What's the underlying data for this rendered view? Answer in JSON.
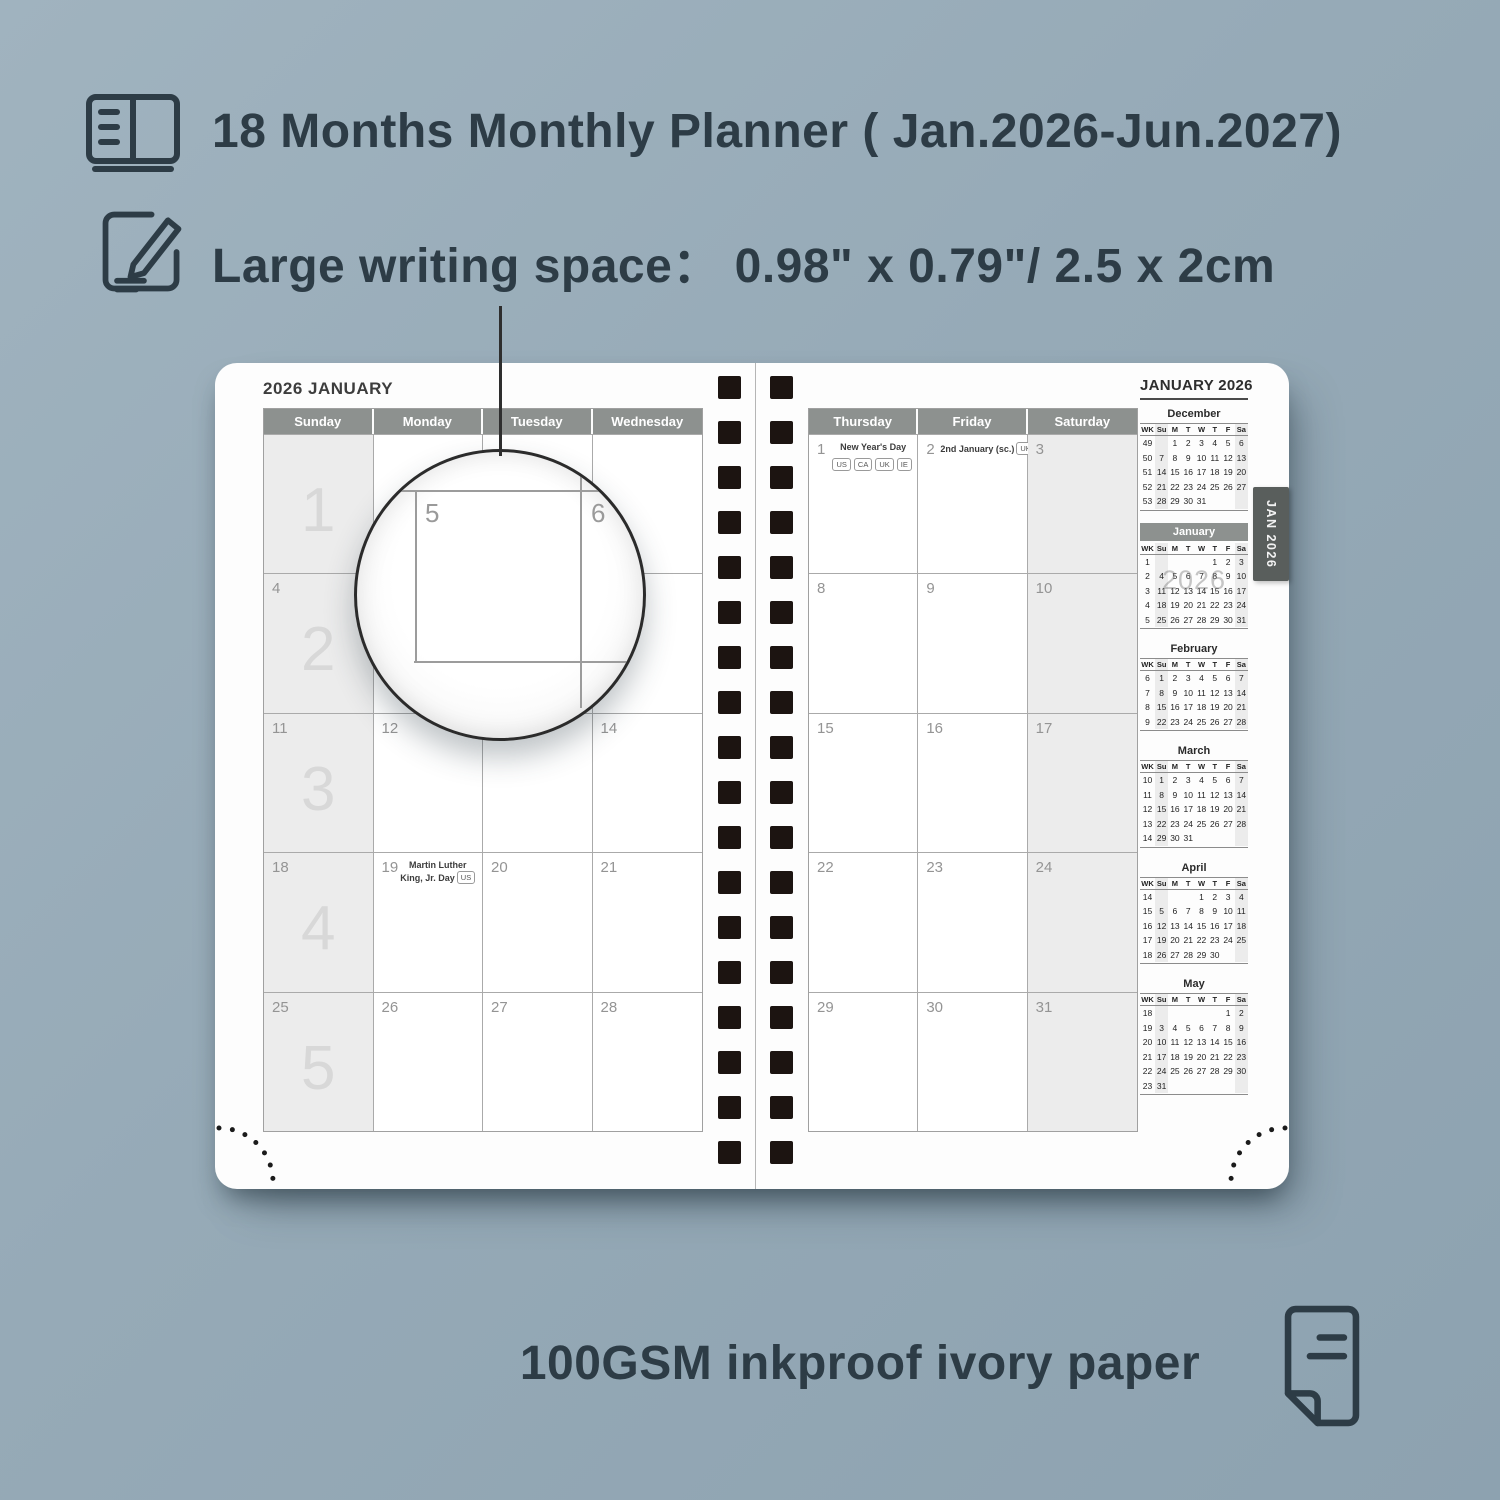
{
  "features": {
    "months_range": "18 Months Monthly Planner ( Jan.2026-Jun.2027)",
    "writing_space": "Large writing space：  0.98\" x 0.79\"/ 2.5 x 2cm",
    "paper": "100GSM inkproof ivory paper"
  },
  "icons": {
    "months_range": "open-book-icon",
    "writing_space": "note-pencil-icon",
    "paper": "paper-sheet-icon"
  },
  "lens": {
    "magnified_dates": [
      "5",
      "6"
    ]
  },
  "planner": {
    "left_page_title": "2026 JANUARY",
    "right_page_title": "JANUARY 2026",
    "tab_label": "JAN 2026",
    "binding_holes_per_column": 18,
    "left_day_headers": [
      "Sunday",
      "Monday",
      "Tuesday",
      "Wednesday"
    ],
    "right_day_headers": [
      "Thursday",
      "Friday",
      "Saturday"
    ],
    "week_numbers": [
      "1",
      "2",
      "3",
      "4",
      "5"
    ],
    "left_weeks": [
      {
        "cells": [
          {
            "d": ""
          },
          {
            "d": ""
          },
          {
            "d": ""
          },
          {
            "d": ""
          }
        ]
      },
      {
        "cells": [
          {
            "d": "4"
          },
          {
            "d": "5"
          },
          {
            "d": "6"
          },
          {
            "d": "7"
          }
        ]
      },
      {
        "cells": [
          {
            "d": "11"
          },
          {
            "d": "12"
          },
          {
            "d": "13"
          },
          {
            "d": "14"
          }
        ]
      },
      {
        "cells": [
          {
            "d": "18"
          },
          {
            "d": "19",
            "holiday": "Martin Luther\nKing, Jr. Day",
            "badges": [
              "US"
            ],
            "badges_below": false
          },
          {
            "d": "20"
          },
          {
            "d": "21"
          }
        ]
      },
      {
        "cells": [
          {
            "d": "25"
          },
          {
            "d": "26"
          },
          {
            "d": "27"
          },
          {
            "d": "28"
          }
        ]
      }
    ],
    "right_weeks": [
      {
        "cells": [
          {
            "d": "1",
            "holiday": "New Year's Day",
            "badges": [
              "US",
              "CA",
              "UK",
              "IE"
            ],
            "badges_below": true
          },
          {
            "d": "2",
            "holiday": "2nd January (sc.)",
            "badges": [
              "UK"
            ],
            "badges_below": false
          },
          {
            "d": "3"
          }
        ]
      },
      {
        "cells": [
          {
            "d": "8"
          },
          {
            "d": "9"
          },
          {
            "d": "10"
          }
        ]
      },
      {
        "cells": [
          {
            "d": "15"
          },
          {
            "d": "16"
          },
          {
            "d": "17"
          }
        ]
      },
      {
        "cells": [
          {
            "d": "22"
          },
          {
            "d": "23"
          },
          {
            "d": "24"
          }
        ]
      },
      {
        "cells": [
          {
            "d": "29"
          },
          {
            "d": "30"
          },
          {
            "d": "31"
          }
        ]
      }
    ],
    "mini_header": [
      "WK",
      "Su",
      "M",
      "T",
      "W",
      "T",
      "F",
      "Sa"
    ],
    "mini_months": [
      {
        "name": "December",
        "current": false,
        "rows": [
          [
            "49",
            "",
            "1",
            "2",
            "3",
            "4",
            "5",
            "6"
          ],
          [
            "50",
            "7",
            "8",
            "9",
            "10",
            "11",
            "12",
            "13"
          ],
          [
            "51",
            "14",
            "15",
            "16",
            "17",
            "18",
            "19",
            "20"
          ],
          [
            "52",
            "21",
            "22",
            "23",
            "24",
            "25",
            "26",
            "27"
          ],
          [
            "53",
            "28",
            "29",
            "30",
            "31",
            "",
            "",
            ""
          ]
        ]
      },
      {
        "name": "January",
        "current": true,
        "watermark": "2026",
        "rows": [
          [
            "1",
            "",
            "",
            "",
            "",
            "1",
            "2",
            "3"
          ],
          [
            "2",
            "4",
            "5",
            "6",
            "7",
            "8",
            "9",
            "10"
          ],
          [
            "3",
            "11",
            "12",
            "13",
            "14",
            "15",
            "16",
            "17"
          ],
          [
            "4",
            "18",
            "19",
            "20",
            "21",
            "22",
            "23",
            "24"
          ],
          [
            "5",
            "25",
            "26",
            "27",
            "28",
            "29",
            "30",
            "31"
          ]
        ]
      },
      {
        "name": "February",
        "current": false,
        "rows": [
          [
            "6",
            "1",
            "2",
            "3",
            "4",
            "5",
            "6",
            "7"
          ],
          [
            "7",
            "8",
            "9",
            "10",
            "11",
            "12",
            "13",
            "14"
          ],
          [
            "8",
            "15",
            "16",
            "17",
            "18",
            "19",
            "20",
            "21"
          ],
          [
            "9",
            "22",
            "23",
            "24",
            "25",
            "26",
            "27",
            "28"
          ]
        ]
      },
      {
        "name": "March",
        "current": false,
        "rows": [
          [
            "10",
            "1",
            "2",
            "3",
            "4",
            "5",
            "6",
            "7"
          ],
          [
            "11",
            "8",
            "9",
            "10",
            "11",
            "12",
            "13",
            "14"
          ],
          [
            "12",
            "15",
            "16",
            "17",
            "18",
            "19",
            "20",
            "21"
          ],
          [
            "13",
            "22",
            "23",
            "24",
            "25",
            "26",
            "27",
            "28"
          ],
          [
            "14",
            "29",
            "30",
            "31",
            "",
            "",
            "",
            ""
          ]
        ]
      },
      {
        "name": "April",
        "current": false,
        "rows": [
          [
            "14",
            "",
            "",
            "",
            "1",
            "2",
            "3",
            "4"
          ],
          [
            "15",
            "5",
            "6",
            "7",
            "8",
            "9",
            "10",
            "11"
          ],
          [
            "16",
            "12",
            "13",
            "14",
            "15",
            "16",
            "17",
            "18"
          ],
          [
            "17",
            "19",
            "20",
            "21",
            "22",
            "23",
            "24",
            "25"
          ],
          [
            "18",
            "26",
            "27",
            "28",
            "29",
            "30",
            "",
            ""
          ]
        ]
      },
      {
        "name": "May",
        "current": false,
        "rows": [
          [
            "18",
            "",
            "",
            "",
            "",
            "",
            "1",
            "2"
          ],
          [
            "19",
            "3",
            "4",
            "5",
            "6",
            "7",
            "8",
            "9"
          ],
          [
            "20",
            "10",
            "11",
            "12",
            "13",
            "14",
            "15",
            "16"
          ],
          [
            "21",
            "17",
            "18",
            "19",
            "20",
            "21",
            "22",
            "23"
          ],
          [
            "22",
            "24",
            "25",
            "26",
            "27",
            "28",
            "29",
            "30"
          ],
          [
            "23",
            "31",
            "",
            "",
            "",
            "",
            "",
            ""
          ]
        ]
      }
    ]
  },
  "colors": {
    "background": "#96aab7",
    "text_dark": "#2d3c46",
    "header_gray": "#8d918f",
    "tab_gray": "#595e5c",
    "shaded_column": "#ececec",
    "grid_line": "#aaaaaa",
    "binding_black": "#1c1411",
    "week_number_gray": "#d8d8d8",
    "paper_white": "#fdfdfd"
  }
}
